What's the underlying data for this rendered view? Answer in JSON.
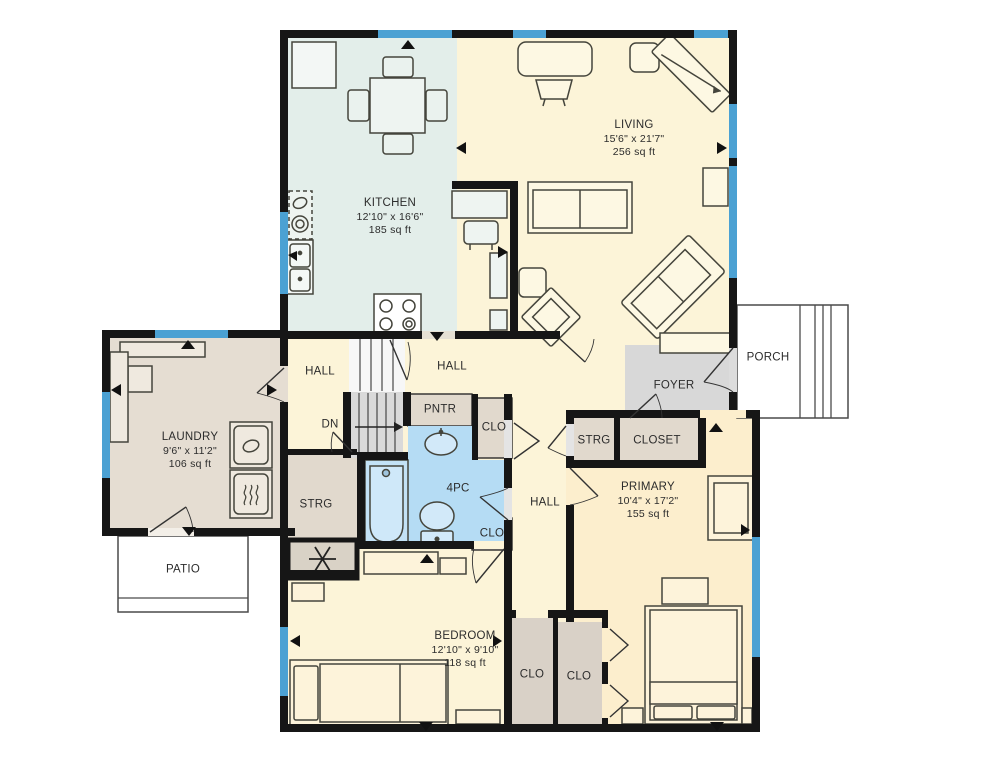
{
  "document": {
    "type": "residential-floor-plan",
    "background": "#ffffff"
  },
  "labels": {
    "kitchen": {
      "name": "KITCHEN",
      "dims": "12'10\" x 16'6\"",
      "area": "185 sq ft"
    },
    "living": {
      "name": "LIVING",
      "dims": "15'6\" x 21'7\"",
      "area": "256 sq ft"
    },
    "laundry": {
      "name": "LAUNDRY",
      "dims": "9'6\" x 11'2\"",
      "area": "106 sq ft"
    },
    "primary": {
      "name": "PRIMARY",
      "dims": "10'4\" x 17'2\"",
      "area": "155 sq ft"
    },
    "bedroom": {
      "name": "BEDROOM",
      "dims": "12'10\" x 9'10\"",
      "area": "118 sq ft"
    },
    "patio": {
      "name": "PATIO"
    },
    "porch": {
      "name": "PORCH"
    },
    "foyer": {
      "name": "FOYER"
    },
    "hall_left": {
      "name": "HALL"
    },
    "hall_center": {
      "name": "HALL"
    },
    "hall_right": {
      "name": "HALL"
    },
    "stairs_down": {
      "name": "DN"
    },
    "pantry": {
      "name": "PNTR"
    },
    "bath": {
      "name": "4PC"
    },
    "strg_left": {
      "name": "STRG"
    },
    "strg_right": {
      "name": "STRG"
    },
    "closet_primary": {
      "name": "CLOSET"
    },
    "clo_hall_upper": {
      "name": "CLO"
    },
    "clo_bath": {
      "name": "CLO"
    },
    "clo_bedroom": {
      "name": "CLO"
    },
    "clo_primary": {
      "name": "CLO"
    }
  },
  "colors": {
    "wall": "#161616",
    "window": "#4ba1d3",
    "kitchen_fill": "#e3eeea",
    "cream_fill": "#fcf4d8",
    "primary_fill": "#fceecd",
    "laundry_fill": "#e5ddd2",
    "closet_fill": "#e0d8cc",
    "foyer_fill": "#d8d8d8",
    "bath_fill": "#b5dcf4",
    "stair_fill": "#d9d9d9"
  },
  "fixtures": [
    "refrigerator",
    "dining-table-with-chairs",
    "kitchen-sink",
    "cooktop",
    "desk-chair",
    "washer",
    "dryer",
    "furnace",
    "bathtub",
    "toilet",
    "vanity-sink",
    "sofa",
    "tv-console",
    "armchair",
    "loveseat",
    "coffee-table",
    "side-table",
    "bed",
    "dresser",
    "nightstand",
    "stairs-down",
    "porch-steps"
  ]
}
